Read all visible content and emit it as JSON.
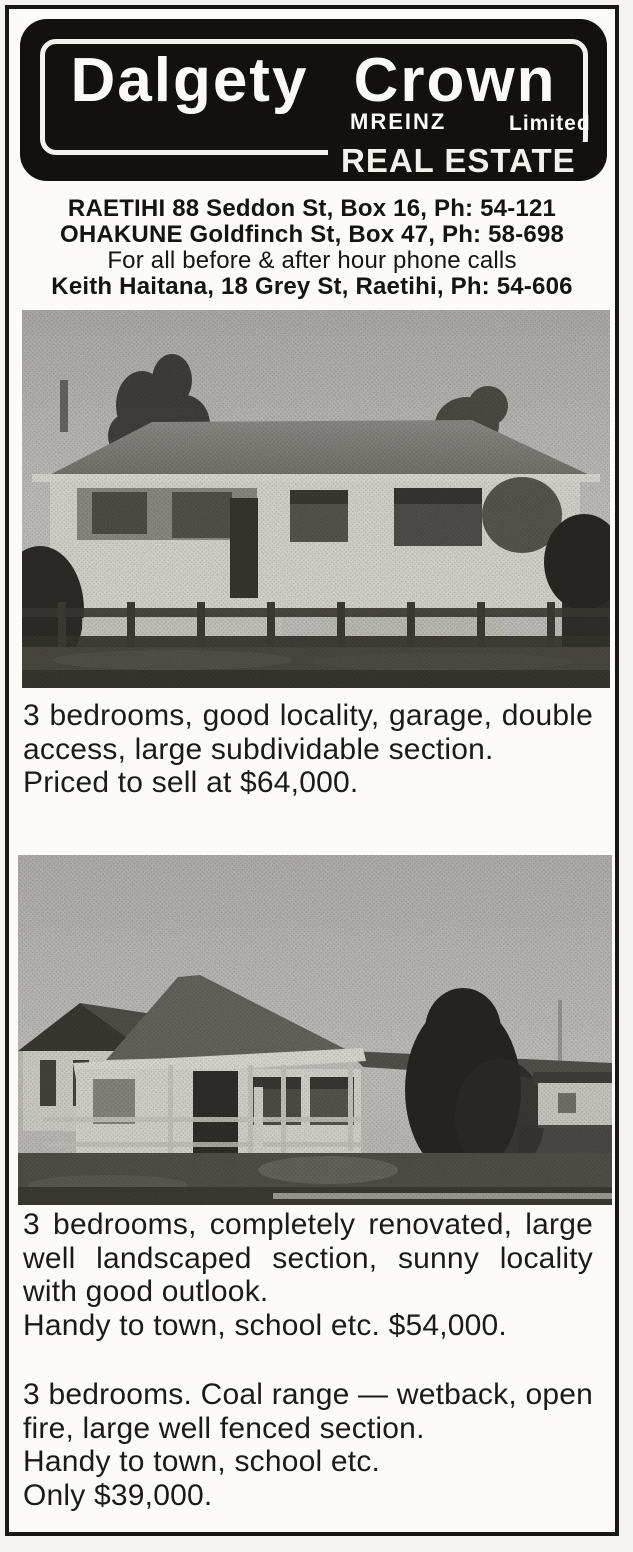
{
  "colors": {
    "ink": "#12110e",
    "paper": "#fcfbf8"
  },
  "brand": {
    "name": "Dalgety Crown",
    "mreinz": "MREINZ",
    "limited": "Limited",
    "tagline": "REAL ESTATE"
  },
  "contacts": {
    "raetihi": "RAETIHI 88 Seddon St, Box 16, Ph: 54-121",
    "ohakune": "OHAKUNE Goldfinch St, Box 47, Ph: 58-698",
    "after_hours_note": "For all before & after hour phone calls",
    "agent": "Keith Haitana, 18 Grey St, Raetihi, Ph: 54-606"
  },
  "listings": [
    {
      "photo": "veranda-bungalow-with-front-fence",
      "description": "3 bedrooms, good locality, garage, double access, large subdividable section.",
      "price_line": "Priced to sell at $64,000."
    },
    {
      "photo": "renovated-hip-roof-bungalow-with-conifer",
      "description": "3 bedrooms, completely renovated, large well landscaped section, sunny locality with good outlook.",
      "price_line": "Handy to town, school etc. $54,000."
    },
    {
      "photo": null,
      "description": "3 bedrooms. Coal range — wetback, open fire, large well fenced section.",
      "handy_line": "Handy to town, school etc.",
      "price_line": "Only $39,000."
    }
  ]
}
